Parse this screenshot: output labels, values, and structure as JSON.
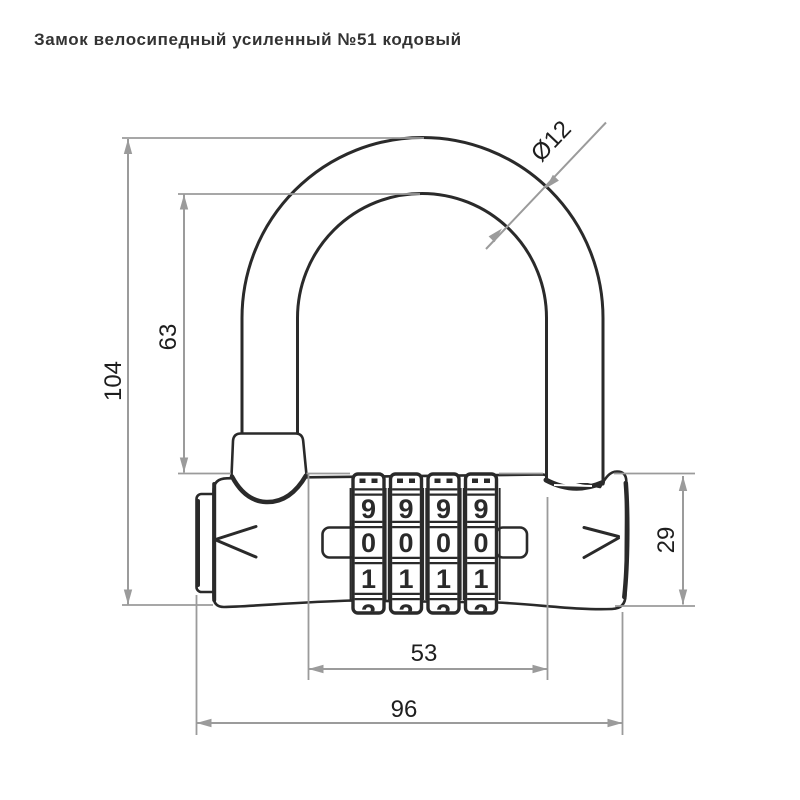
{
  "title": "Замок велосипедный усиленный №51 кодовый",
  "dimensions": {
    "total_height": "104",
    "inner_height": "63",
    "shackle_diameter": "Ø12",
    "body_height": "29",
    "dials_width": "53",
    "total_width": "96"
  },
  "dials": {
    "wheel_count": 4,
    "visible_digits": [
      "9",
      "0",
      "1"
    ],
    "partial_bottom_digit": "2"
  },
  "colors": {
    "line": "#2a2a2a",
    "dimension_line": "#9b9b9b",
    "label_text": "#1e1e1e",
    "title_text": "#333333",
    "background": "#ffffff"
  }
}
